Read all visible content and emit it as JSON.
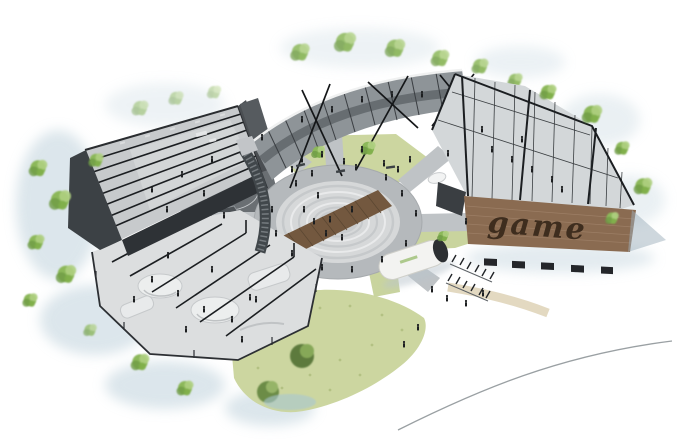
{
  "signage": {
    "game_wall_text": "game"
  },
  "colors": {
    "background": "#ffffff",
    "tree_green": "#8cb85a",
    "tree_green_light": "#aecf7f",
    "tree_green_dark": "#6e9b45",
    "shadow_wash_blue": "#bfd2dc",
    "building_dark_gray": "#3c4145",
    "building_wall_deep": "#2e3236",
    "steel_frame_black": "#1b1e21",
    "concrete_light": "#dcdedf",
    "paving_gray": "#b5b9bc",
    "court_asphalt": "#6a6f73",
    "grass_green": "#ccd6a0",
    "brick_brown": "#8a6b51",
    "wood_deck_brown": "#73583f",
    "sign_text_brown": "#3e2d1e",
    "figure_black": "#1c1e20",
    "road_line_gray": "#9aa0a3",
    "tube_white": "#f3f3f1"
  }
}
